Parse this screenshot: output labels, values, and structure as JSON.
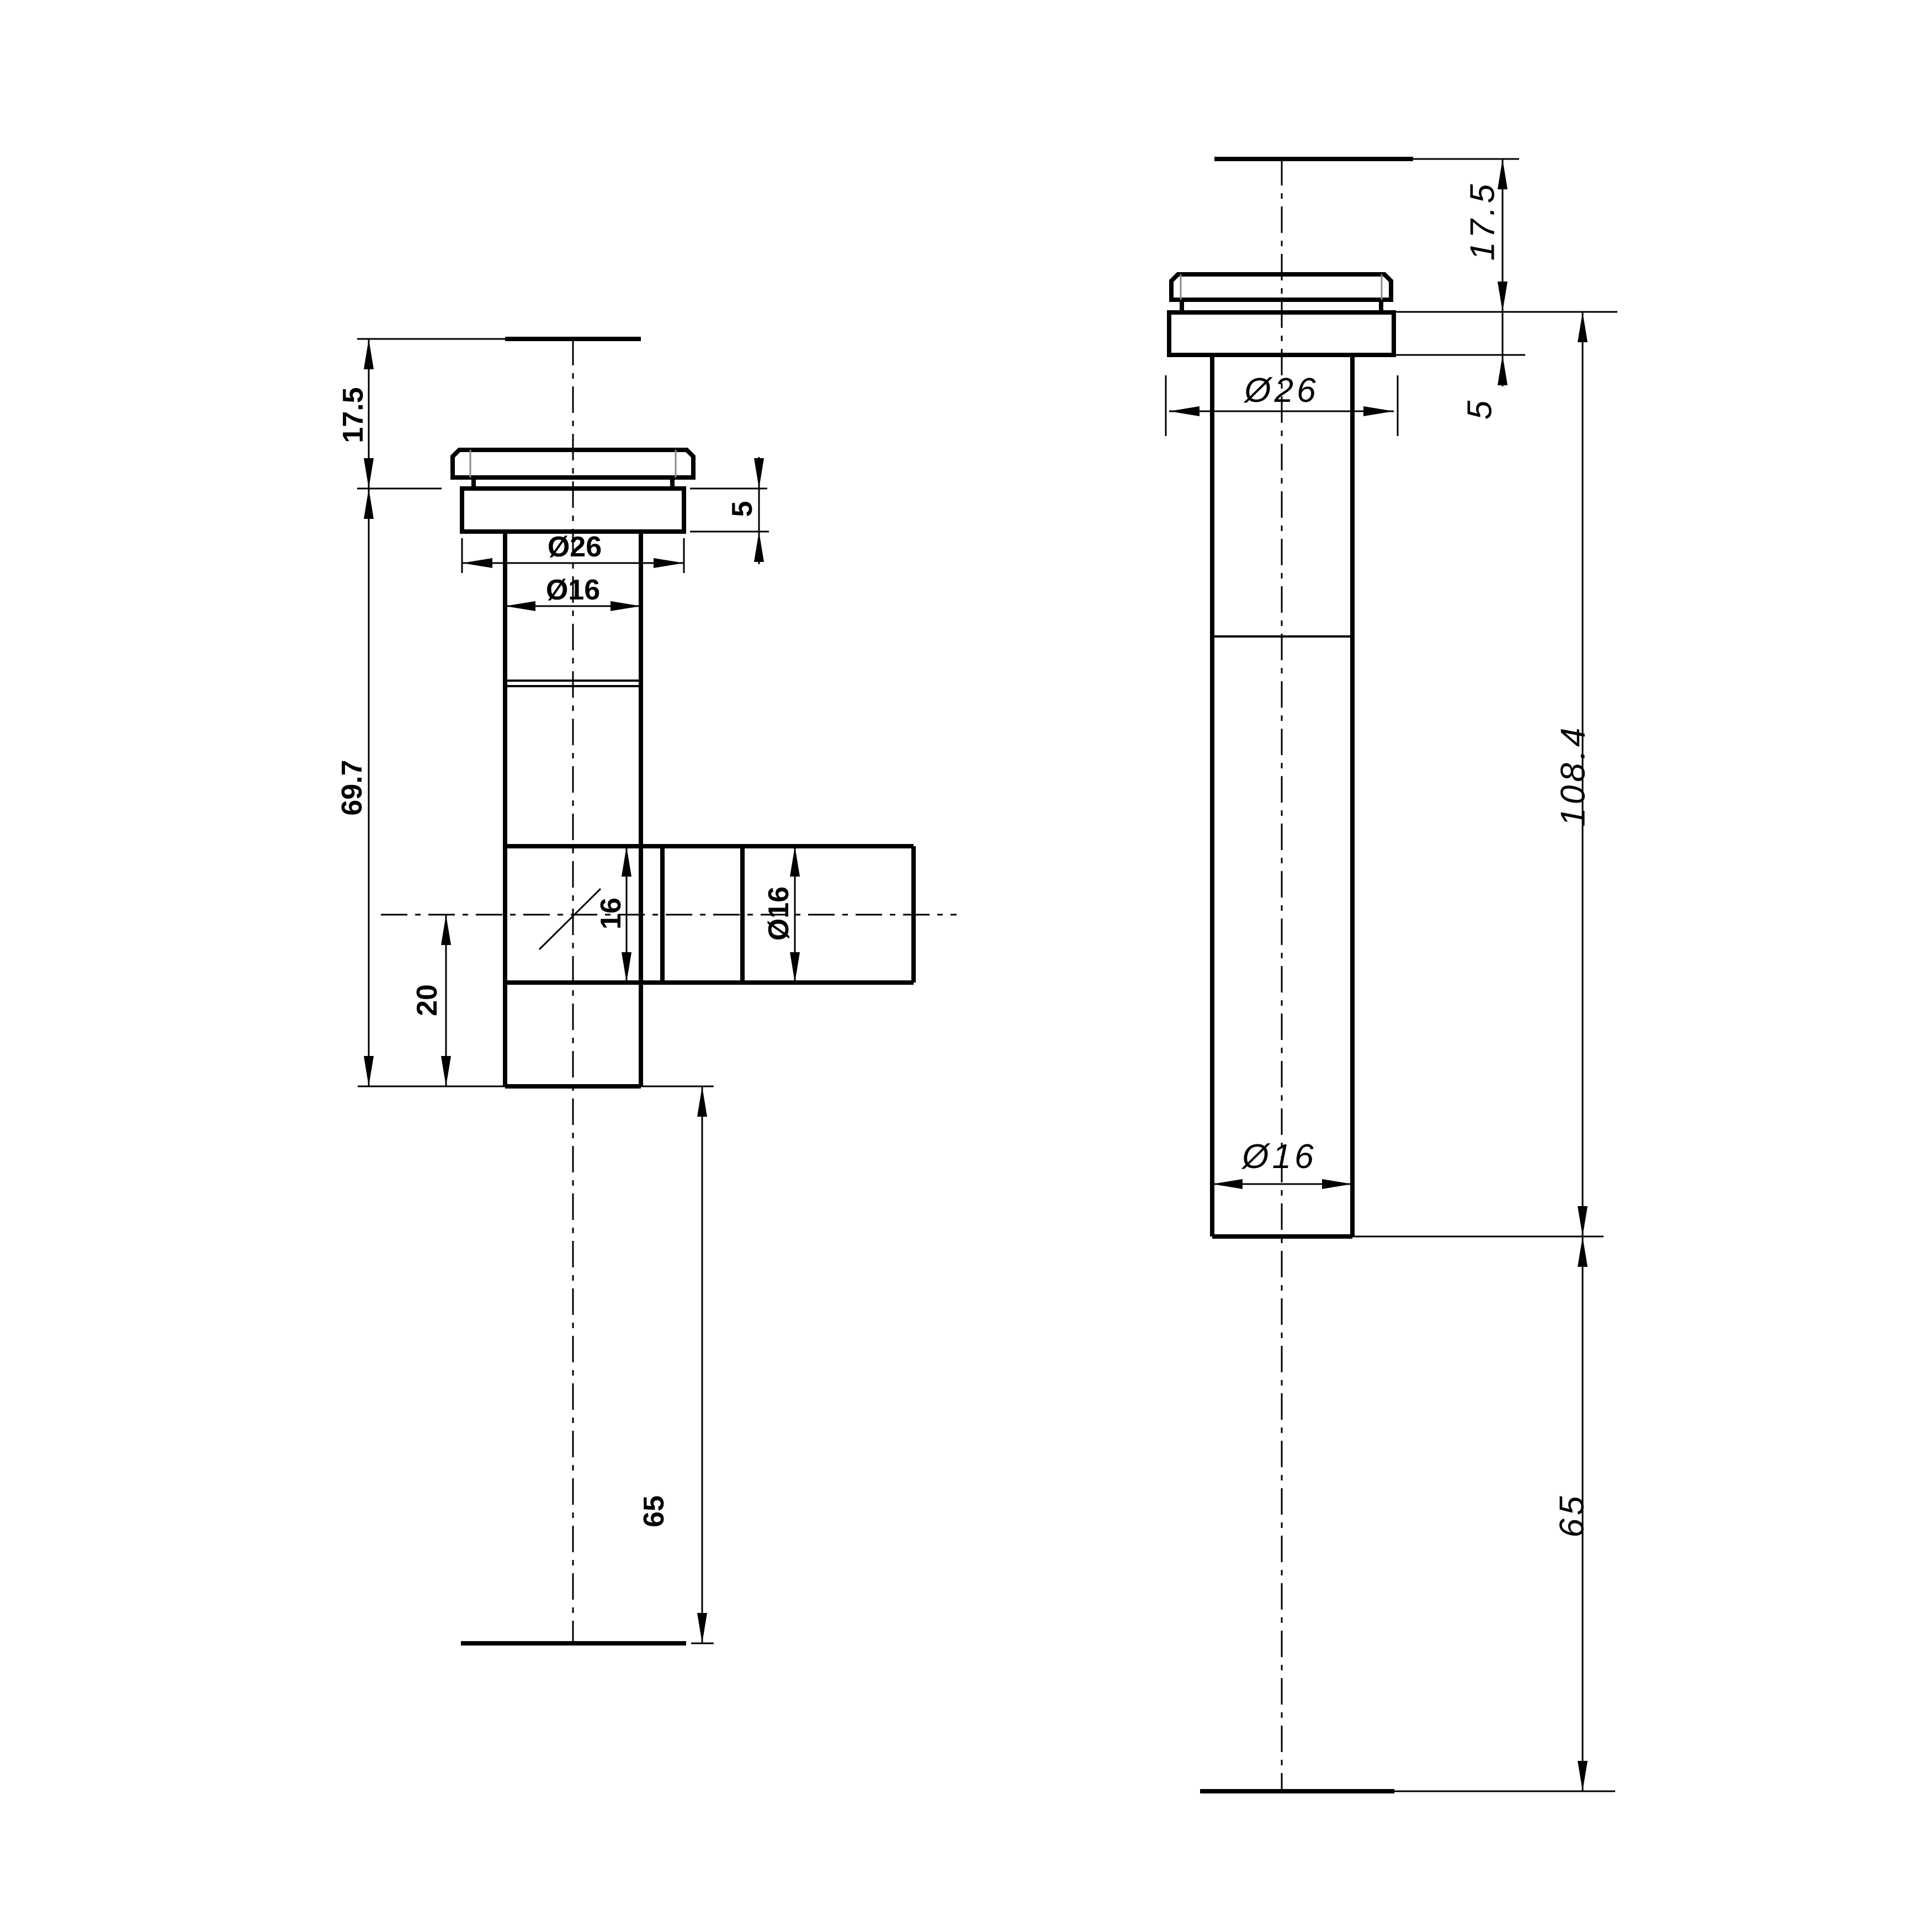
{
  "drawing": {
    "kind": "engineering-dimension-drawing",
    "background_color": "#ffffff",
    "line_color": "#000000",
    "inner_edge_color": "#8a8a8a",
    "views": {
      "left": {
        "name": "spout-with-side-branch",
        "dims": {
          "cap_height": "17.5",
          "flange_height": "5",
          "cap_diameter": "Ø26",
          "pipe_diameter": "Ø16",
          "body_length": "69.7",
          "tee_bore": "16",
          "branch_diameter": "Ø16",
          "branch_offset": "20",
          "tail_length": "65"
        }
      },
      "right": {
        "name": "straight-spout",
        "dims": {
          "cap_height": "17.5",
          "flange_height": "5",
          "cap_diameter": "Ø26",
          "total_length": "108.4",
          "pipe_diameter": "Ø16",
          "tail_length": "65"
        }
      }
    }
  }
}
